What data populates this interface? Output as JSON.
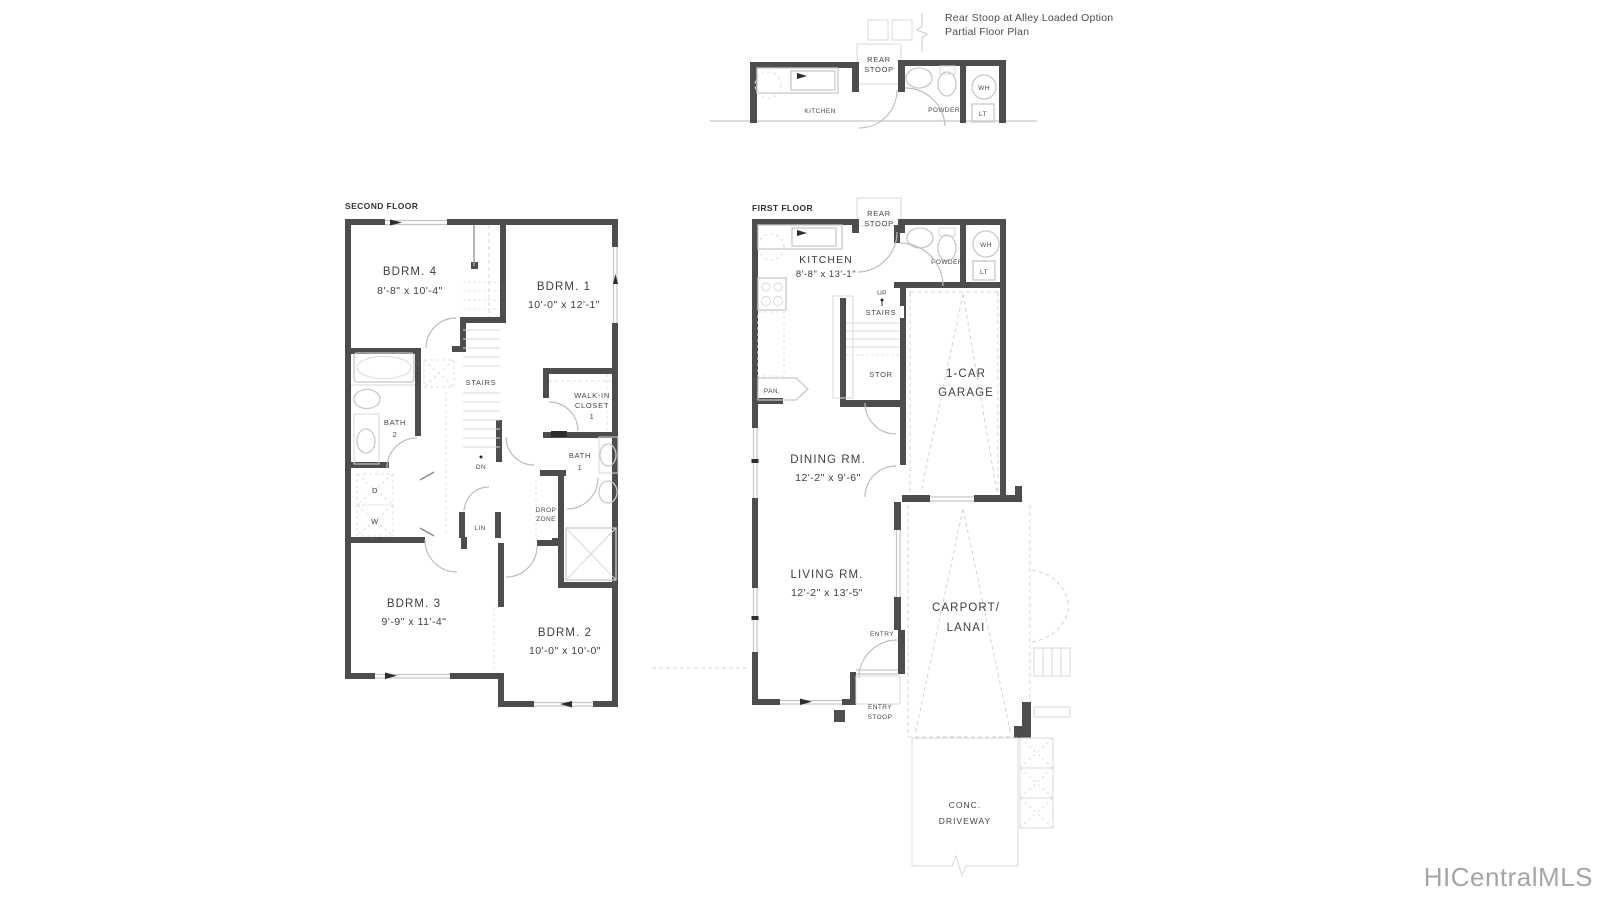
{
  "annotation": {
    "line1": "Rear Stoop at Alley Loaded Option",
    "line2": "Partial Floor Plan"
  },
  "watermark": "HICentralMLS",
  "partial_plan": {
    "rear": "REAR",
    "stoop": "STOOP",
    "kitchen": "KITCHEN",
    "powder": "POWDER",
    "wh": "WH",
    "lt": "LT"
  },
  "second_floor": {
    "title": "SECOND FLOOR",
    "bdrm4_name": "BDRM. 4",
    "bdrm4_dims": "8'-8\" x 10'-4\"",
    "bdrm1_name": "BDRM. 1",
    "bdrm1_dims": "10'-0\" x 12'-1\"",
    "bdrm3_name": "BDRM. 3",
    "bdrm3_dims": "9'-9\" x 11'-4\"",
    "bdrm2_name": "BDRM. 2",
    "bdrm2_dims": "10'-0\" x 10'-0\"",
    "stairs": "STAIRS",
    "dn": "DN",
    "bath2_l1": "BATH",
    "bath2_l2": "2",
    "bath1_l1": "BATH",
    "bath1_l2": "1",
    "walkin_l1": "WALK-IN",
    "walkin_l2": "CLOSET",
    "walkin_l3": "1",
    "drop_l1": "DROP",
    "drop_l2": "ZONE",
    "dryer": "D",
    "washer": "W",
    "linen": "LIN"
  },
  "first_floor": {
    "title": "FIRST FLOOR",
    "rear": "REAR",
    "stoop": "STOOP",
    "kitchen_name": "KITCHEN",
    "kitchen_dims": "8'-8\" x 13'-1\"",
    "powder": "POWDER",
    "wh": "WH",
    "lt": "LT",
    "up": "UP",
    "stairs": "STAIRS",
    "stor": "STOR",
    "pan": "PAN.",
    "garage_l1": "1-CAR",
    "garage_l2": "GARAGE",
    "dining_name": "DINING RM.",
    "dining_dims": "12'-2\" x 9'-6\"",
    "living_name": "LIVING RM.",
    "living_dims": "12'-2\" x 13'-5\"",
    "carport_l1": "CARPORT/",
    "carport_l2": "LANAI",
    "entry": "ENTRY",
    "entry_stoop_l1": "ENTRY",
    "entry_stoop_l2": "STOOP",
    "conc": "CONC.",
    "driveway": "DRIVEWAY"
  },
  "colors": {
    "wall": "#4d4d4d",
    "fixture": "#c8c8c8",
    "text": "#3e3e3e",
    "watermark": "#a5a5a5"
  }
}
